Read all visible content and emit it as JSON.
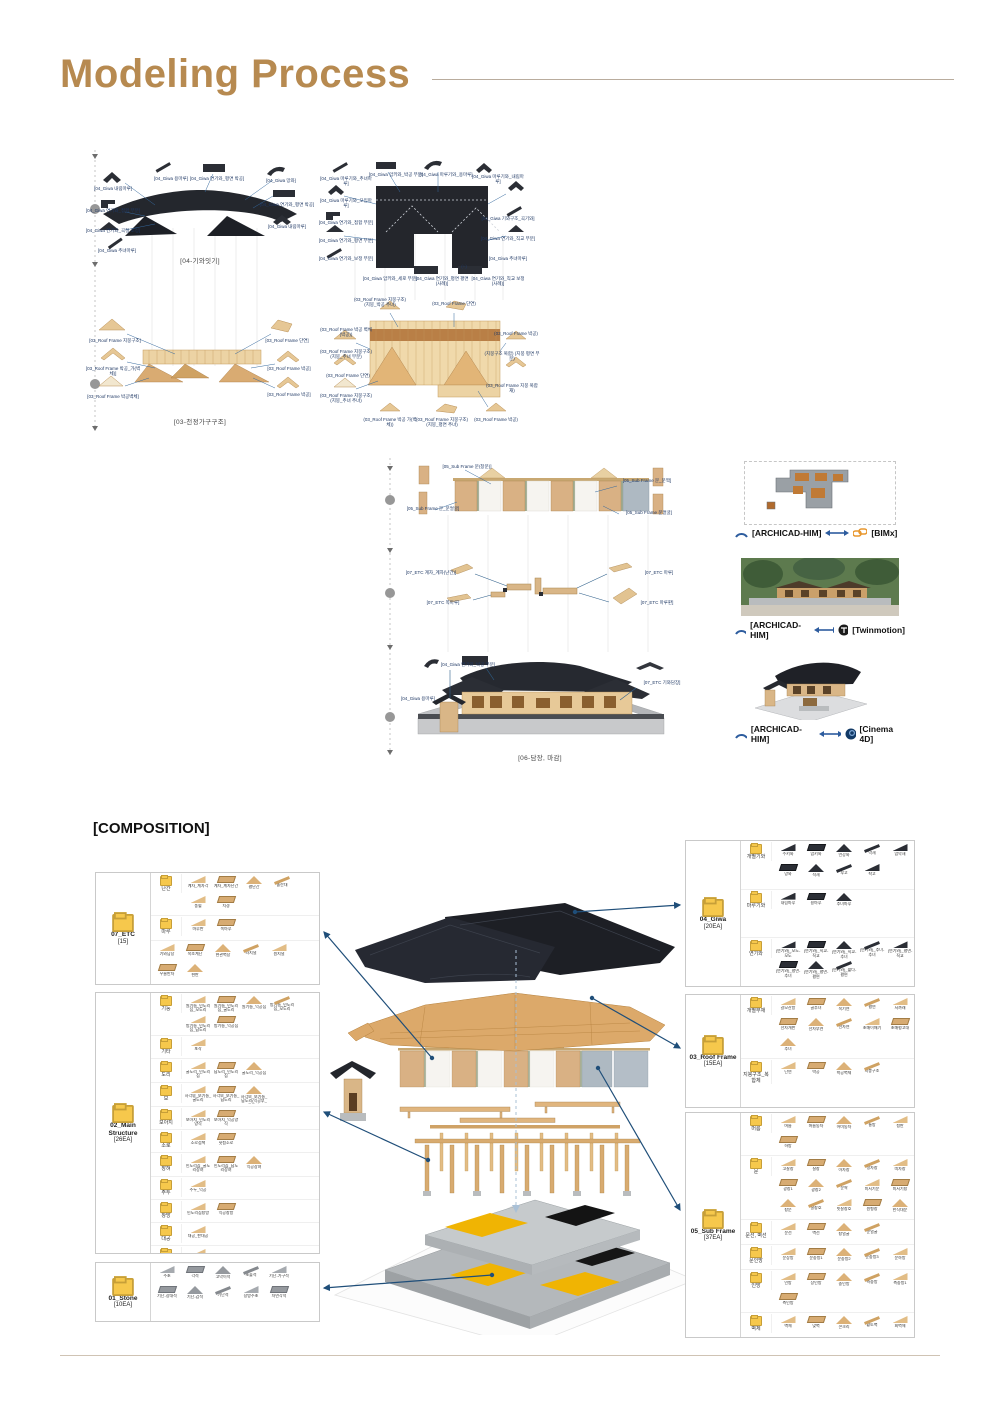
{
  "title": "Modeling Process",
  "composition_header": "[COMPOSITION]",
  "accent_color": "#b78a50",
  "arrow_color": "#1f4e79",
  "diagrams": {
    "giwa_elev": {
      "caption": "[04-기와잇기]",
      "labels": [
        {
          "t": "[04_Giwa 내림마루]",
          "x": 0,
          "y": 36
        },
        {
          "t": "[04_Giwa 용마루]",
          "x": 58,
          "y": 26
        },
        {
          "t": "[04_Giwa 연기와_평면 박공]",
          "x": 104,
          "y": 26
        },
        {
          "t": "[04_Giwa 망와]",
          "x": 168,
          "y": 28
        },
        {
          "t": "[04_Giwa 연기와_접합 부분]",
          "x": 0,
          "y": 58
        },
        {
          "t": "[04_Giwa 연기와_평면 박공]",
          "x": 174,
          "y": 52
        },
        {
          "t": "[04_Giwa 연기와_곡절 조정]",
          "x": 0,
          "y": 78
        },
        {
          "t": "[04_Giwa 내림마루]",
          "x": 174,
          "y": 74
        },
        {
          "t": "[04_Giwa 추녀마루]",
          "x": 4,
          "y": 98
        }
      ]
    },
    "giwa_plan": {
      "labels": [
        {
          "t": "[04_Giwa 마루기와_추녀마루]",
          "x": 0,
          "y": 28
        },
        {
          "t": "[04_Giwa 암키와_박공 부분]",
          "x": 50,
          "y": 24
        },
        {
          "t": "[04_Giwa 마루기와_용마루]",
          "x": 100,
          "y": 24
        },
        {
          "t": "[04_Giwa 마루기와_내림마루]",
          "x": 152,
          "y": 26
        },
        {
          "t": "[04_Giwa 마루기와_모임마루]",
          "x": 0,
          "y": 50
        },
        {
          "t": "[04_Giwa 연기와_접합 부분]",
          "x": 0,
          "y": 72
        },
        {
          "t": "[04_Giwa 연기와_평면 부분]",
          "x": 0,
          "y": 90
        },
        {
          "t": "[04_Giwa 연기와_보정 부분]",
          "x": 0,
          "y": 108
        },
        {
          "t": "[04_Giwa 기와구조_곡기와]",
          "x": 162,
          "y": 68
        },
        {
          "t": "[04_Giwa 연기와_직교 부분]",
          "x": 162,
          "y": 88
        },
        {
          "t": "[04_Giwa 추녀마루]",
          "x": 162,
          "y": 108
        },
        {
          "t": "[04_Giwa 암키와_세로 부분]",
          "x": 44,
          "y": 128
        },
        {
          "t": "[04_Giwa 연기와_평면 평면(사례)]",
          "x": 96,
          "y": 128
        },
        {
          "t": "[04_Giwa 연기와_직교 보정(사례)]",
          "x": 152,
          "y": 128
        },
        {
          "t": "(+)",
          "x": 118,
          "y": 116
        }
      ]
    },
    "roof_elev": {
      "caption": "[03-천정가구구조]",
      "labels": [
        {
          "t": "[03_Roof Frame 지붕구조]",
          "x": 2,
          "y": 40
        },
        {
          "t": "[03_Roof Frame 단연]",
          "x": 174,
          "y": 40
        },
        {
          "t": "[03_Roof Frame 박공_가(벽체)]",
          "x": 0,
          "y": 68
        },
        {
          "t": "[03_Roof Frame 박공]",
          "x": 176,
          "y": 68
        },
        {
          "t": "[03_Roof Frame 박공벽체]",
          "x": 0,
          "y": 96
        },
        {
          "t": "[03_Roof Frame 박공]",
          "x": 176,
          "y": 94
        }
      ]
    },
    "roof_plan": {
      "labels": [
        {
          "t": "(03_Roof Frame 지붕구조) (지붕_박공 추녀)",
          "x": 34,
          "y": 4
        },
        {
          "t": "(03_Roof Frame 단연)",
          "x": 108,
          "y": 8
        },
        {
          "t": "(03_Roof Frame 박공 벽체(박공))",
          "x": 0,
          "y": 34
        },
        {
          "t": "(03_Roof Frame 박공)",
          "x": 170,
          "y": 38
        },
        {
          "t": "(03_Roof Frame 지붕구조) (지붕_추녀 부분)",
          "x": 0,
          "y": 56
        },
        {
          "t": "(지붕구조 복합) (지붕 평면 부분)",
          "x": 166,
          "y": 58
        },
        {
          "t": "(03_Roof Frame 단연)",
          "x": 2,
          "y": 80
        },
        {
          "t": "(03_Roof Frame 지붕구조) (지붕_추녀 추녀)",
          "x": 0,
          "y": 100
        },
        {
          "t": "(03_Roof Frame 박공 가(벽체))",
          "x": 44,
          "y": 124
        },
        {
          "t": "(03_Roof Frame 지붕구조) (지붕_평면 추녀)",
          "x": 96,
          "y": 124
        },
        {
          "t": "(03_Roof Frame 박공)",
          "x": 150,
          "y": 124
        },
        {
          "t": "(03_Roof Frame 지붕 복합재)",
          "x": 166,
          "y": 90
        }
      ]
    },
    "wall_layer": {
      "labels": [
        {
          "t": "[05_Sub Frame 문(창문)]",
          "x": 44,
          "y": 6
        },
        {
          "t": "[05_Sub Frame 문_문짝]",
          "x": 224,
          "y": 20
        },
        {
          "t": "[05_Sub Frame 문_문얼굴]",
          "x": 10,
          "y": 48
        },
        {
          "t": "[05_Sub Frame 문얼굴]",
          "x": 226,
          "y": 52
        }
      ]
    },
    "etc_layer": {
      "labels": [
        {
          "t": "[07_ETC 계자_계자(난간)]",
          "x": 8,
          "y": 22
        },
        {
          "t": "[07_ETC 쪽마루]",
          "x": 20,
          "y": 52
        },
        {
          "t": "[07_ETC 마루]",
          "x": 236,
          "y": 22
        },
        {
          "t": "[07_ETC 마루판]",
          "x": 234,
          "y": 52
        }
      ]
    },
    "final": {
      "caption": "[06-담장, 마감]",
      "labels": [
        {
          "t": "[04_Giwa 연기와_박공 부분]",
          "x": 50,
          "y": 22
        },
        {
          "t": "[04_Giwa 용마루]",
          "x": 0,
          "y": 56
        },
        {
          "t": "[07_ETC 기와담장]",
          "x": 244,
          "y": 40
        }
      ]
    }
  },
  "exports": [
    {
      "left": "[ARCHICAD-HIM]",
      "right": "[BIMx]"
    },
    {
      "left": "[ARCHICAD-HIM]",
      "right": "[Twinmotion]"
    },
    {
      "left": "[ARCHICAD-HIM]",
      "right": "[Cinema 4D]"
    }
  ],
  "panels": [
    {
      "id": "etc",
      "title": "07_ETC",
      "count": "[15]",
      "groups": [
        {
          "label": "난간",
          "items": [
            "계자_계자각",
            "계자_계자난간",
            "평난간",
            "돌란대",
            "풍혈",
            "치경"
          ]
        },
        {
          "label": "마루",
          "items": [
            "마루판",
            "쪽마루"
          ]
        },
        {
          "label": "",
          "items": [
            "기와담장",
            "목조계단",
            "현관벽장",
            "라지널",
            "원지널",
            "우물반자",
            "현판"
          ]
        }
      ]
    },
    {
      "id": "main",
      "title": "02_Main Structure",
      "count": "[26EA]",
      "groups": [
        {
          "label": "기둥",
          "items": [
            "원기둥_민도리집_모도리",
            "원기둥_민도리집_굴도리",
            "원기둥_익공집",
            "방기둥_민도리집_모도리",
            "방기둥_민도리집_납도리",
            "방기둥_익공집"
          ]
        },
        {
          "label": "기타",
          "items": [
            "포작"
          ]
        },
        {
          "label": "도리",
          "items": [
            "굴도리_민도리집",
            "납도리_민도리집",
            "굴도리_익공집"
          ]
        },
        {
          "label": "보",
          "items": [
            "사각보_보기둥_굴도리",
            "사각보_보기둥_납도리",
            "사각보_보기둥_납도리(익공부_굴도리)"
          ]
        },
        {
          "label": "보아지",
          "items": [
            "보아지_민도리양식",
            "보아지_익공양식"
          ]
        },
        {
          "label": "소로",
          "items": [
            "소로접책",
            "헛첨소로"
          ]
        },
        {
          "label": "장혀",
          "items": [
            "민도리집_굴도리장혀",
            "민도리집_납도리장혀",
            "익공장혀"
          ]
        },
        {
          "label": "주두",
          "items": [
            "주두_익공"
          ]
        },
        {
          "label": "창방",
          "items": [
            "민도리집창방",
            "익공창방"
          ]
        },
        {
          "label": "대공",
          "items": [
            "대공_판대공"
          ]
        },
        {
          "label": "평방",
          "items": [
            "평방"
          ]
        }
      ]
    },
    {
      "id": "stone",
      "title": "01_Stone",
      "count": "[10EA]",
      "groups": [
        {
          "label": "",
          "tone": "stone",
          "items": [
            "주초",
            "각석",
            "고막이석",
            "초출석",
            "기단-가구석",
            "기단-장대석",
            "기단-갑석",
            "기단석",
            "장방주초",
            "자연각석"
          ]
        }
      ]
    },
    {
      "id": "giwa",
      "title": "04_Giwa",
      "count": "[20EA]",
      "groups": [
        {
          "label": "개별기와",
          "tone": "dark",
          "items": [
            "수키와",
            "암키와",
            "언강와",
            "막새",
            "암막새",
            "망와",
            "적새",
            "부고",
            "착고"
          ]
        },
        {
          "label": "마루기와",
          "tone": "dark",
          "items": [
            "내림마루",
            "용마루",
            "추녀마루"
          ]
        },
        {
          "label": "연기와",
          "tone": "dark",
          "items": [
            "(연기와)_모도-모도",
            "(연기와)_직교-직교",
            "(연기와)_직교-추녀",
            "(연기와)_추녀-추녀",
            "(연기와)_평면-직교",
            "(연기와)_평면-추녀",
            "(연기와)_평면-평면",
            "(연기와)_짧다-평면"
          ]
        }
      ]
    },
    {
      "id": "roof",
      "title": "03_Roof Frame",
      "count": "[15EA]",
      "groups": [
        {
          "label": "개별부재",
          "items": [
            "갈모산방",
            "골추녀",
            "목기연",
            "평연",
            "서까래",
            "선자개판",
            "선자부연",
            "선자연",
            "초매이매기",
            "초매평고대",
            "추녀"
          ]
        },
        {
          "label": "지붕구조_복합체",
          "items": [
            "단연",
            "박공",
            "박공벽체",
            "지붕구조"
          ]
        }
      ]
    },
    {
      "id": "sub",
      "title": "05_Sub Frame",
      "count": "[37EA]",
      "groups": [
        {
          "label": "머름",
          "items": [
            "머름",
            "머름동자",
            "어미동자",
            "통방",
            "청판",
            "하방"
          ]
        },
        {
          "label": "문",
          "items": [
            "고살창",
            "살창",
            "아자창",
            "정자창",
            "띠자창",
            "광창1",
            "광창2",
            "문짝",
            "미서기문",
            "미서기창",
            "창문",
            "살창호",
            "빗살창호",
            "원형창",
            "한식대문"
          ]
        },
        {
          "label": "문선, 벽선",
          "items": [
            "문선",
            "벽선",
            "창얼굴",
            "문얼굴"
          ]
        },
        {
          "label": "문인방",
          "items": [
            "문상방",
            "문중방1",
            "문중방2",
            "문중방3",
            "문하방"
          ]
        },
        {
          "label": "인방",
          "items": [
            "인방",
            "상인방",
            "중인방",
            "측중방",
            "측중방1",
            "측인방"
          ]
        },
        {
          "label": "벽체",
          "items": [
            "벽체",
            "맞벽",
            "콘크리",
            "황토벽",
            "회벽체"
          ]
        }
      ]
    }
  ]
}
